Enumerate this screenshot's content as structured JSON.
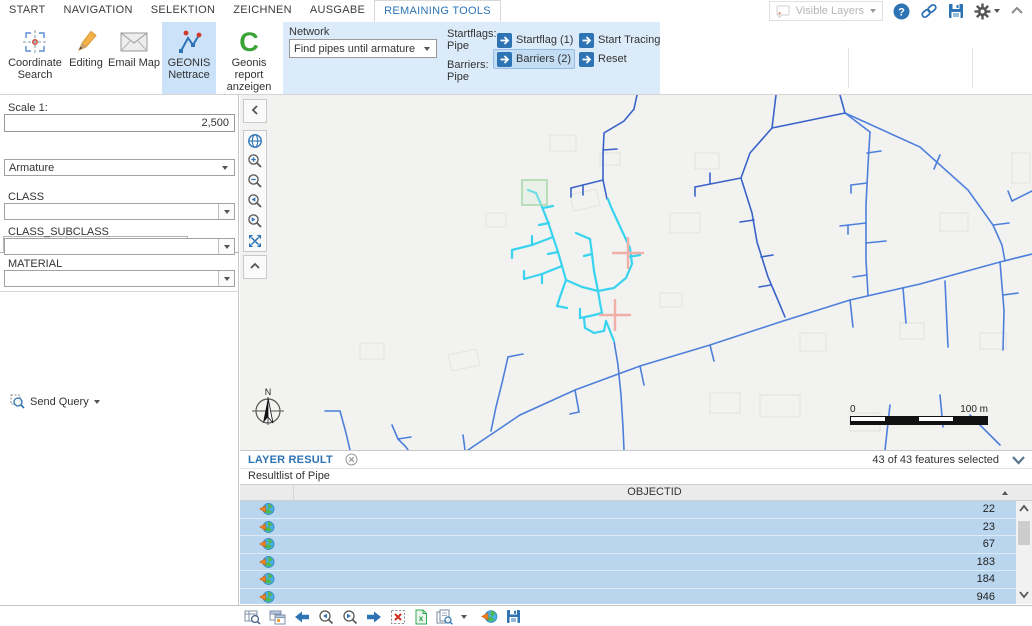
{
  "ribbon": {
    "tabs": [
      "START",
      "NAVIGATION",
      "SELEKTION",
      "ZEICHNEN",
      "AUSGABE",
      "REMAINING TOOLS"
    ],
    "buttons": {
      "coordinate_search": "Coordinate Search",
      "editing": "Editing",
      "email_map": "Email Map",
      "geonis_nettrace": "GEONIS Nettrace",
      "geonis_report": "Geonis report anzeigen"
    },
    "network": {
      "label": "Network",
      "value": "Find pipes until armature cl...",
      "startflags_label": "Startflags:",
      "startflags_value": "Pipe",
      "barriers_label": "Barriers:",
      "barriers_value": "Pipe",
      "startflag_button": "Startflag (1)",
      "barriers_button": "Barriers (2)",
      "start_tracing_button": "Start Tracing",
      "reset_button": "Reset"
    },
    "quickbar": {
      "visible_layers": "Visible Layers"
    }
  },
  "icons": {
    "geonis_report_glyph": "C"
  },
  "left_panel": {
    "scale_label": "Scale 1:",
    "scale_value": "2,500",
    "tabs": [
      "QUERIES",
      "TABLE OF CONTENT"
    ],
    "query_type": "Armature",
    "fields": [
      {
        "label": "CLASS",
        "value": ""
      },
      {
        "label": "CLASS_SUBCLASS",
        "value": ""
      },
      {
        "label": "MATERIAL",
        "value": ""
      }
    ],
    "send_query": "Send Query"
  },
  "map": {
    "compass": "N",
    "scalebar_start": "0",
    "scalebar_end": "100 m"
  },
  "results": {
    "tab": "LAYER RESULT",
    "status": "43 of 43 features selected",
    "subtitle": "Resultlist of Pipe",
    "column_header": "OBJECTID",
    "rows": [
      "22",
      "23",
      "67",
      "183",
      "184",
      "946"
    ]
  },
  "colors": {
    "accent_blue": "#2e74b5",
    "ribbon_group_bg": "#dcebfa",
    "selected_row_bg": "#b9d6ee",
    "pipe_blue": "#4d7fdb",
    "pipe_blue_dark": "#3a63c9",
    "trace_cyan": "#38d4ef",
    "barrier_salmon": "#f0b0a8",
    "startflag_green": "#a8d8a8"
  }
}
